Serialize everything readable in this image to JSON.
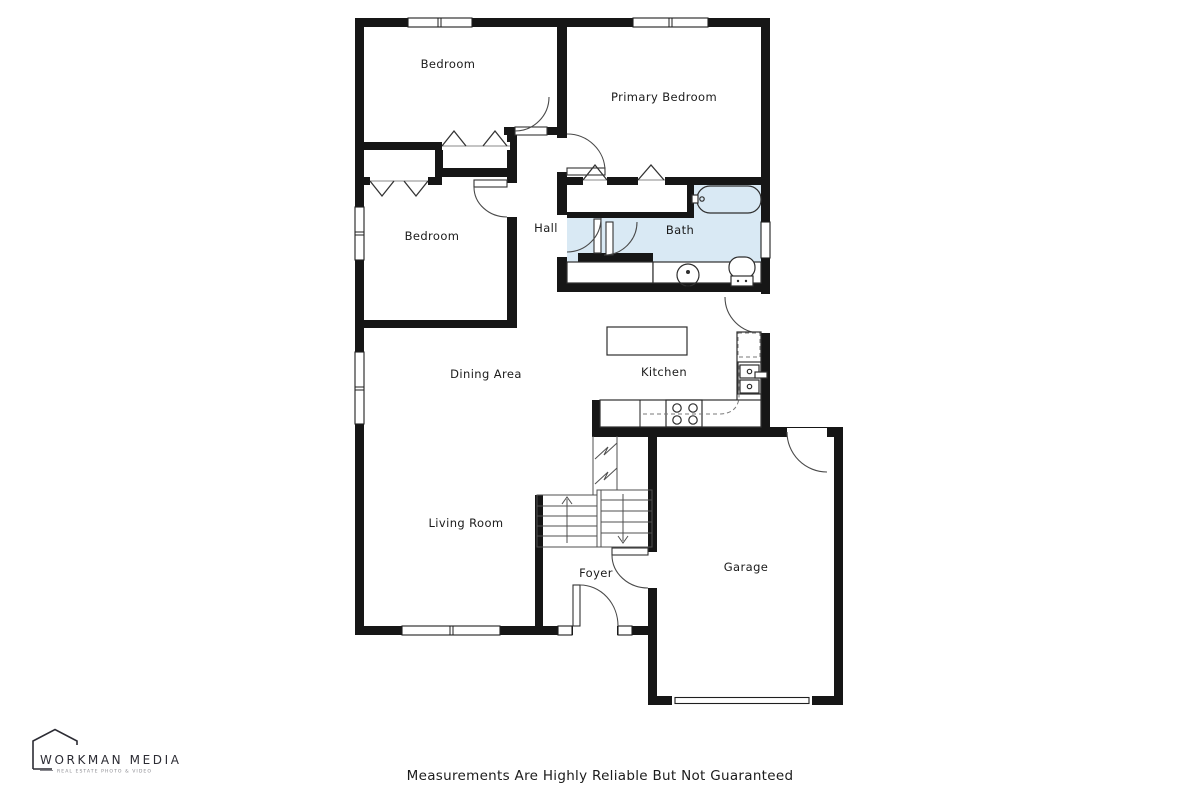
{
  "floorplan": {
    "rooms": {
      "bedroom_top": "Bedroom",
      "primary_bedroom": "Primary Bedroom",
      "bedroom_left": "Bedroom",
      "hall": "Hall",
      "bath": "Bath",
      "dining": "Dining Area",
      "kitchen": "Kitchen",
      "living": "Living Room",
      "foyer": "Foyer",
      "garage": "Garage"
    },
    "colors": {
      "wall": "#161616",
      "bath_fill": "#d9e9f4",
      "background": "#ffffff"
    }
  },
  "branding": {
    "name": "WORKMAN MEDIA",
    "tagline": "REAL ESTATE PHOTO & VIDEO"
  },
  "footer": {
    "disclaimer": "Measurements Are Highly Reliable But Not Guaranteed"
  }
}
